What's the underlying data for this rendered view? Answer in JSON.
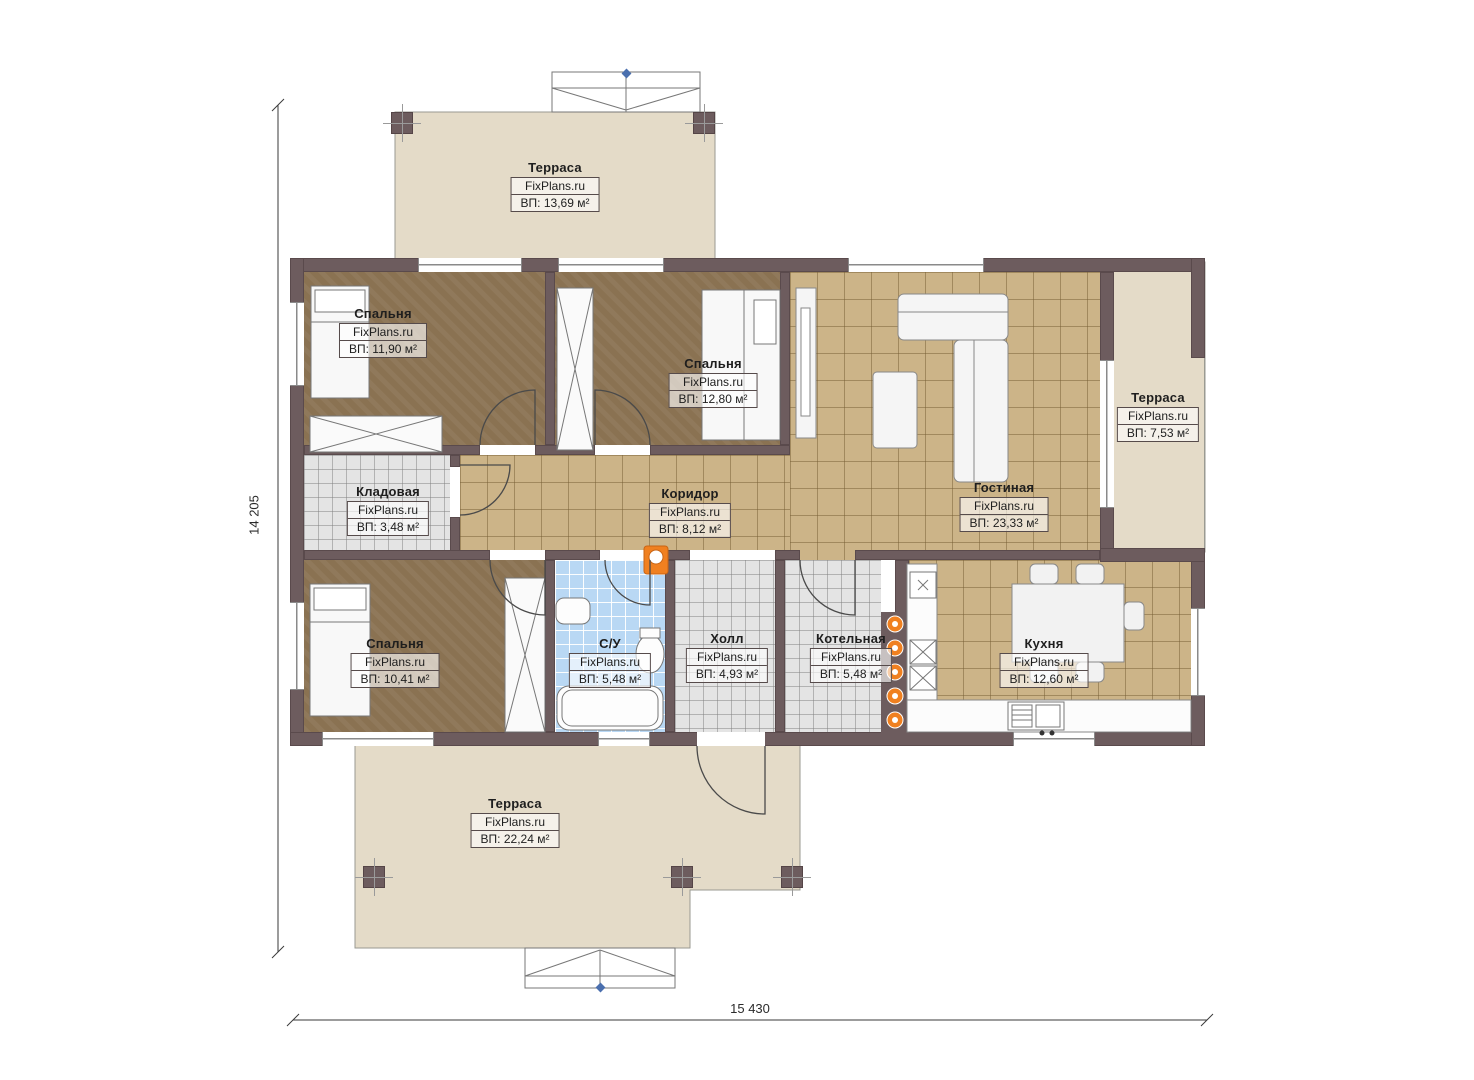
{
  "brand": "FixPlans.ru",
  "dimensions": {
    "height_label": "14 205",
    "width_label": "15 430"
  },
  "rooms": [
    {
      "id": "terrace-top",
      "name": "Терраса",
      "area": "ВП: 13,69 м²"
    },
    {
      "id": "bedroom-1",
      "name": "Спальня",
      "area": "ВП: 11,90 м²"
    },
    {
      "id": "bedroom-2",
      "name": "Спальня",
      "area": "ВП: 12,80 м²"
    },
    {
      "id": "terrace-right",
      "name": "Терраса",
      "area": "ВП: 7,53 м²"
    },
    {
      "id": "storage",
      "name": "Кладовая",
      "area": "ВП: 3,48 м²"
    },
    {
      "id": "corridor",
      "name": "Коридор",
      "area": "ВП: 8,12 м²"
    },
    {
      "id": "living-room",
      "name": "Гостиная",
      "area": "ВП: 23,33 м²"
    },
    {
      "id": "bedroom-3",
      "name": "Спальня",
      "area": "ВП: 10,41 м²"
    },
    {
      "id": "bathroom",
      "name": "С/У",
      "area": "ВП: 5,48 м²"
    },
    {
      "id": "hall",
      "name": "Холл",
      "area": "ВП: 4,93 м²"
    },
    {
      "id": "boiler-room",
      "name": "Котельная",
      "area": "ВП: 5,48 м²"
    },
    {
      "id": "kitchen",
      "name": "Кухня",
      "area": "ВП: 12,60 м²"
    },
    {
      "id": "terrace-bottom",
      "name": "Терраса",
      "area": "ВП: 22,24 м²"
    }
  ],
  "colors": {
    "wall": "#6d5c5e",
    "terrace": "#e4dbc8",
    "bedroom_floor": "#8a7252",
    "tile_tan": "#ccb488",
    "tile_gray": "#e4e4e4",
    "tile_blue": "#b9d8f4",
    "accent_orange": "#f08020",
    "marker_blue": "#4a6fae"
  }
}
